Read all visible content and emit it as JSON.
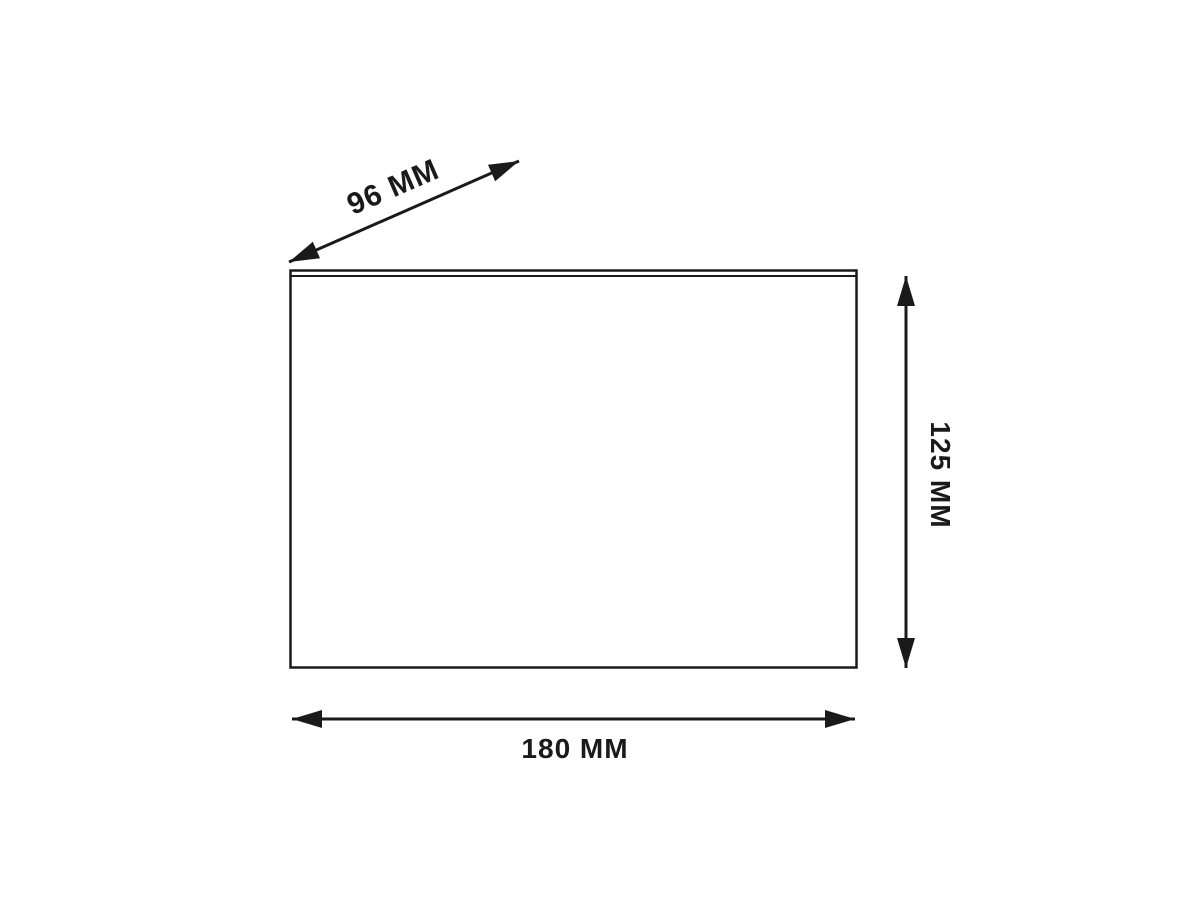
{
  "diagram": {
    "labels": {
      "depth": "96 MM",
      "height": "125 MM",
      "width": "180 MM"
    },
    "colors": {
      "line": "#1a1a1a",
      "background": "#ffffff"
    }
  }
}
